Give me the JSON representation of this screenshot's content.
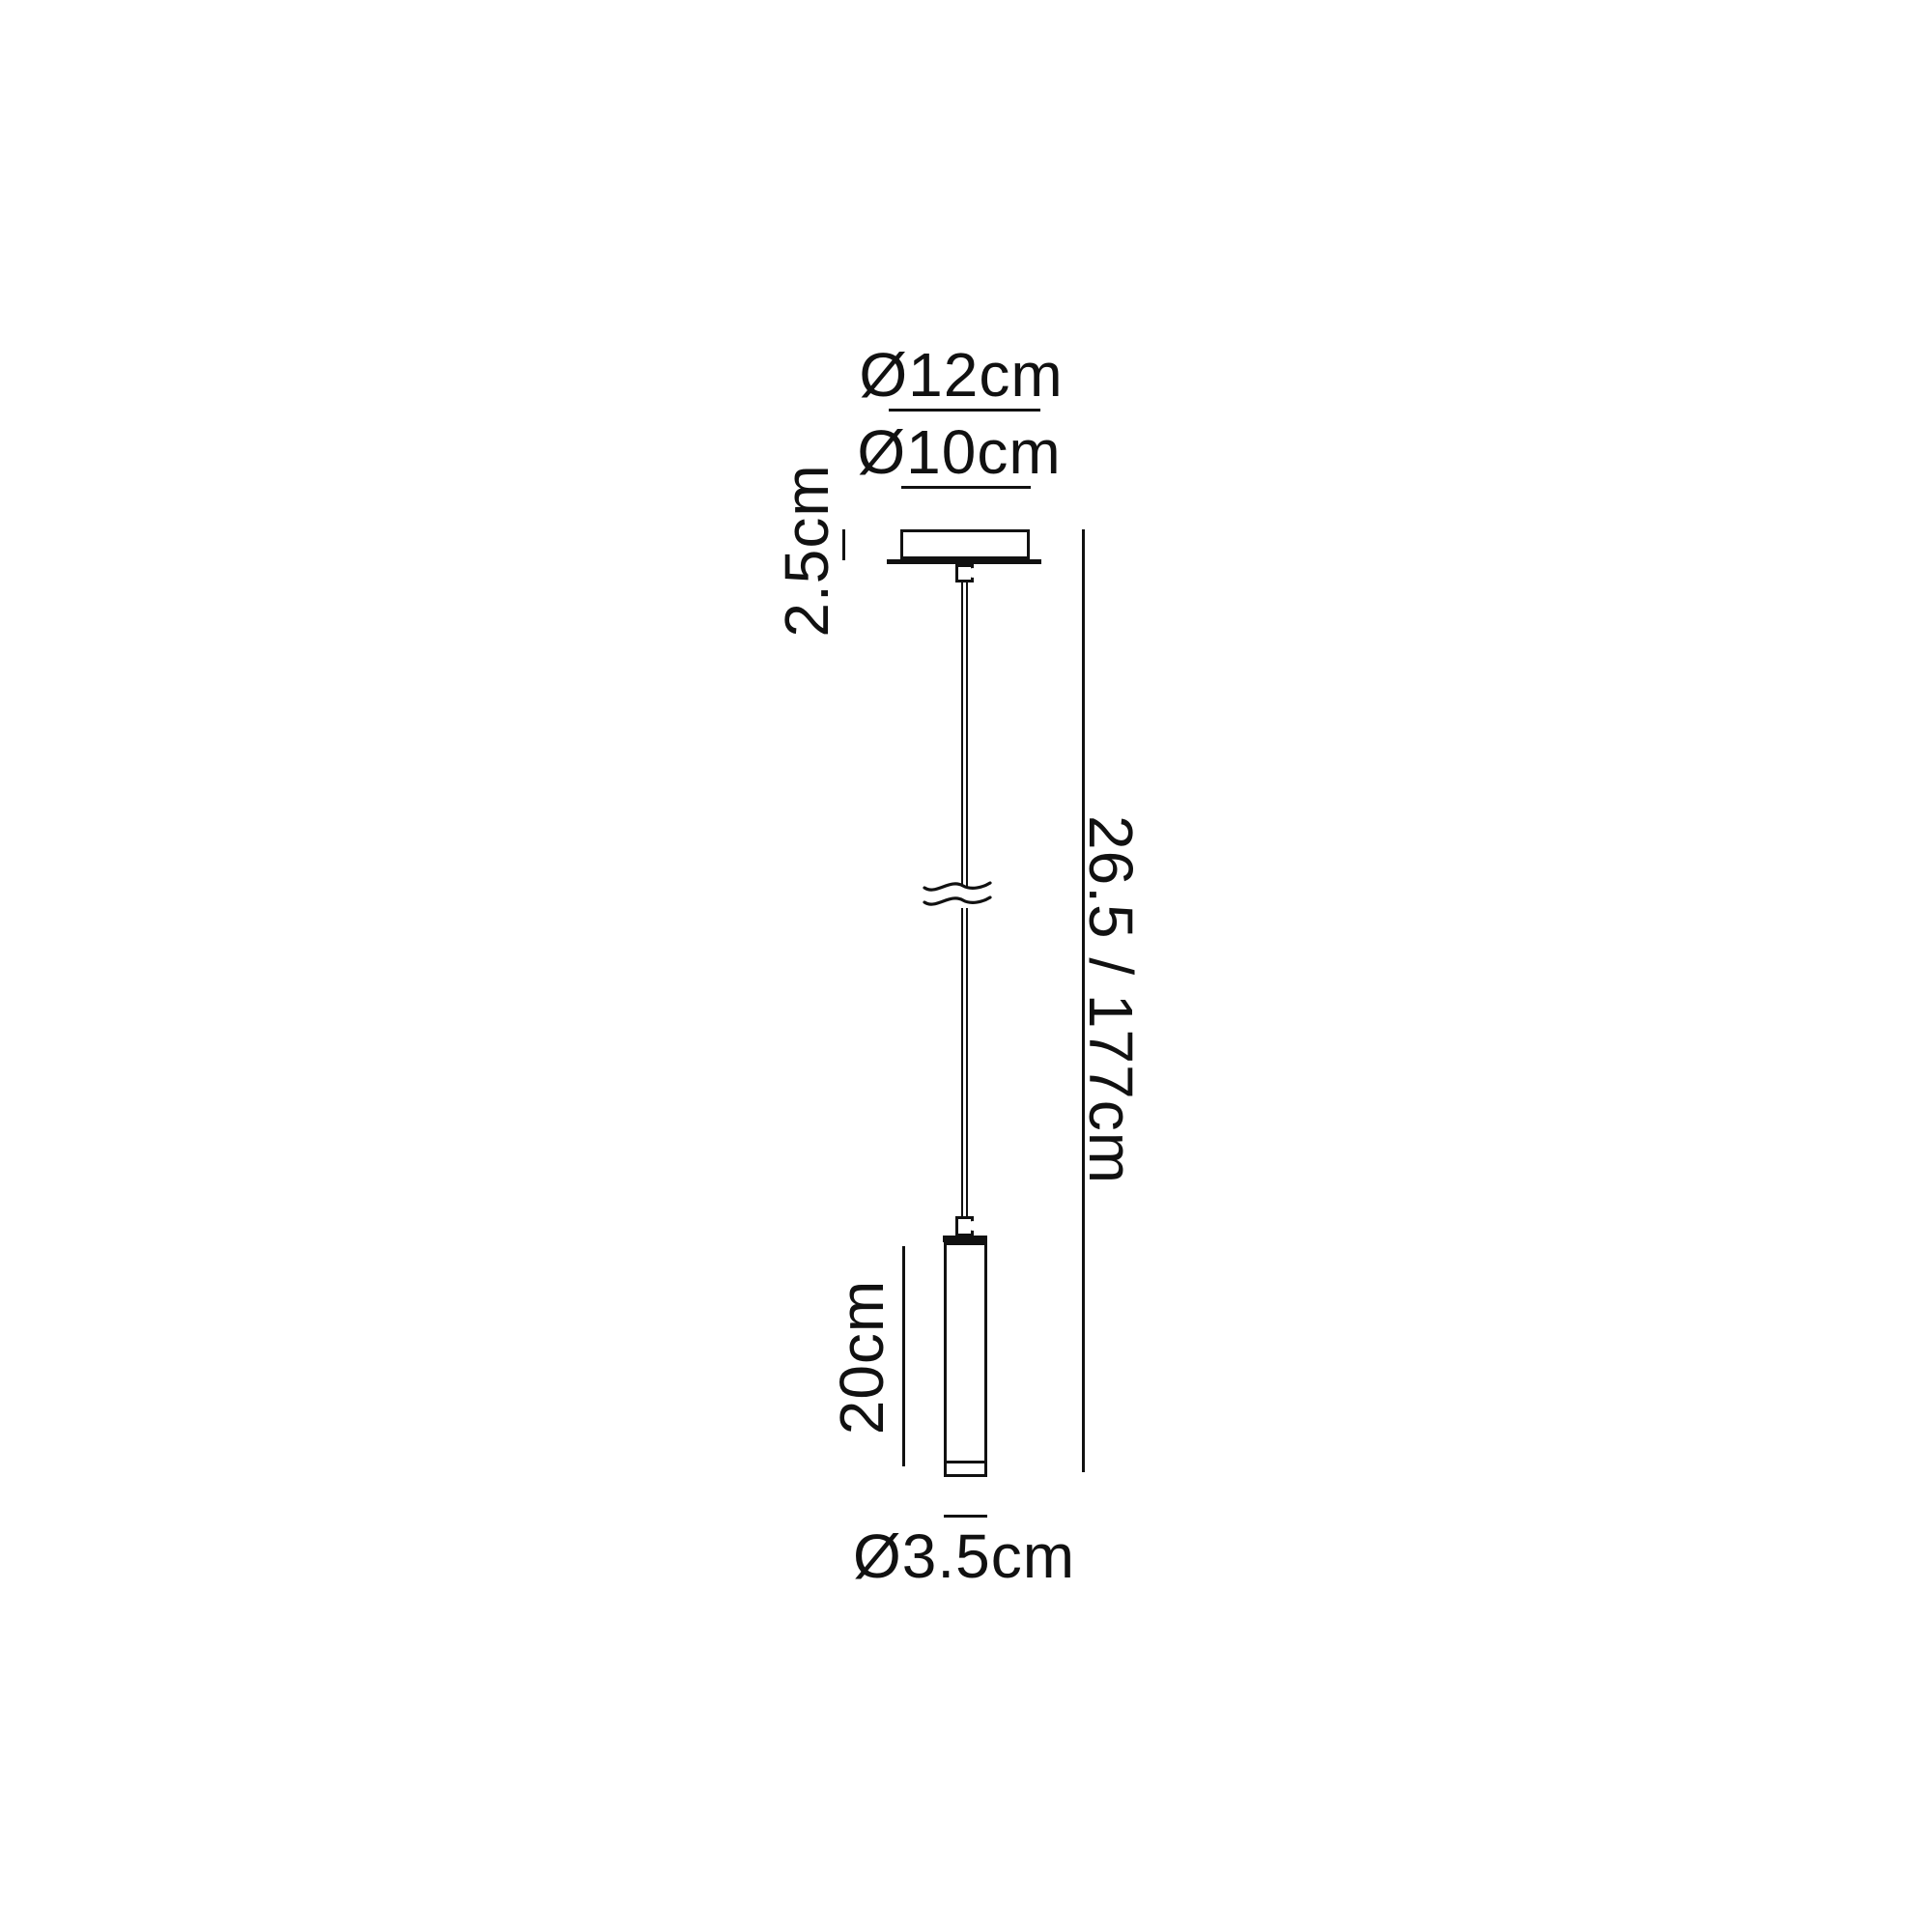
{
  "page": {
    "background": "#ffffff",
    "line_color": "#111111",
    "description_labels_only": true
  },
  "dimensions": {
    "canopy_plate_diameter": "Ø12cm",
    "canopy_diameter": "Ø10cm",
    "canopy_height": "2.5cm",
    "overall_drop": "26.5 / 177cm",
    "shade_height": "20cm",
    "shade_diameter": "Ø3.5cm"
  }
}
